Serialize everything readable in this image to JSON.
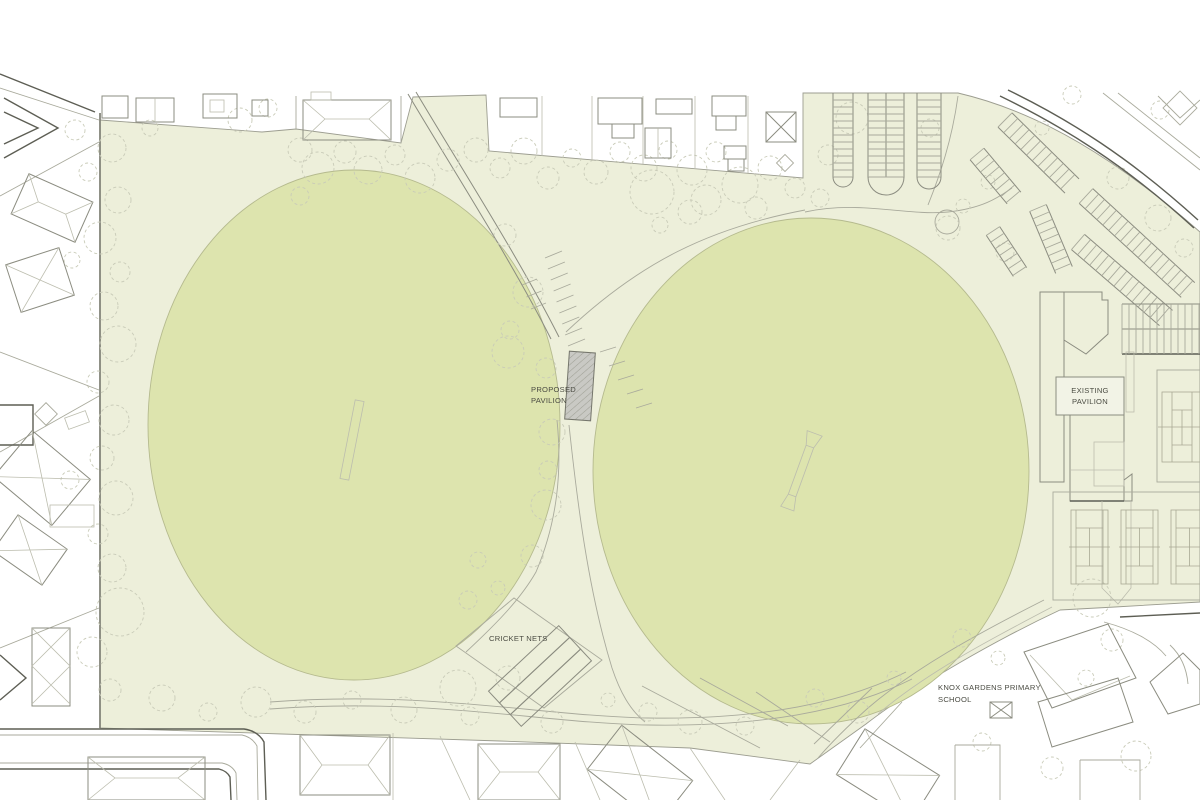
{
  "labels": {
    "proposed_pavilion_line1": "PROPOSED",
    "proposed_pavilion_line2": "PAVILION",
    "existing_pavilion_line1": "EXISTING",
    "existing_pavilion_line2": "PAVILION",
    "cricket_nets": "CRICKET NETS",
    "school_line1": "KNOX GARDENS PRIMARY",
    "school_line2": "SCHOOL"
  },
  "colors": {
    "background": "#ffffff",
    "park_fill": "#edefda",
    "oval_fill": "#dde4ae",
    "pavilion_fill": "#c9c9c4",
    "pavilion_hatch": "#9fa096",
    "label_box_fill": "#f2f3e6",
    "text": "#4b4c43"
  },
  "map": {
    "ovals": [
      {
        "name": "west-oval",
        "cx": 354,
        "cy": 425,
        "rx": 206,
        "ry": 255
      },
      {
        "name": "east-oval",
        "cx": 811,
        "cy": 471,
        "rx": 218,
        "ry": 253
      }
    ],
    "trees": [
      [
        300,
        150,
        12
      ],
      [
        318,
        168,
        16
      ],
      [
        345,
        152,
        11
      ],
      [
        368,
        170,
        14
      ],
      [
        395,
        155,
        10
      ],
      [
        420,
        178,
        15
      ],
      [
        448,
        160,
        11
      ],
      [
        300,
        196,
        9
      ],
      [
        476,
        150,
        12
      ],
      [
        500,
        168,
        10
      ],
      [
        524,
        151,
        13
      ],
      [
        548,
        178,
        11
      ],
      [
        572,
        158,
        9
      ],
      [
        596,
        172,
        12
      ],
      [
        620,
        152,
        10
      ],
      [
        644,
        168,
        13
      ],
      [
        668,
        150,
        9
      ],
      [
        692,
        170,
        15
      ],
      [
        716,
        152,
        10
      ],
      [
        740,
        185,
        18
      ],
      [
        770,
        168,
        12
      ],
      [
        795,
        188,
        10
      ],
      [
        652,
        192,
        22
      ],
      [
        706,
        200,
        15
      ],
      [
        756,
        208,
        11
      ],
      [
        820,
        198,
        9
      ],
      [
        240,
        120,
        12
      ],
      [
        268,
        108,
        9
      ],
      [
        150,
        128,
        8
      ],
      [
        112,
        148,
        14
      ],
      [
        88,
        172,
        9
      ],
      [
        118,
        200,
        13
      ],
      [
        100,
        238,
        16
      ],
      [
        120,
        272,
        10
      ],
      [
        104,
        306,
        14
      ],
      [
        118,
        344,
        18
      ],
      [
        98,
        382,
        11
      ],
      [
        114,
        420,
        15
      ],
      [
        102,
        458,
        12
      ],
      [
        116,
        498,
        17
      ],
      [
        98,
        534,
        10
      ],
      [
        112,
        568,
        14
      ],
      [
        120,
        612,
        24
      ],
      [
        92,
        652,
        15
      ],
      [
        110,
        690,
        11
      ],
      [
        75,
        130,
        10
      ],
      [
        70,
        480,
        9
      ],
      [
        72,
        260,
        8
      ],
      [
        505,
        235,
        11
      ],
      [
        528,
        292,
        15
      ],
      [
        510,
        330,
        9
      ],
      [
        546,
        368,
        10
      ],
      [
        508,
        352,
        16
      ],
      [
        552,
        432,
        13
      ],
      [
        548,
        470,
        9
      ],
      [
        546,
        505,
        15
      ],
      [
        532,
        556,
        11
      ],
      [
        478,
        560,
        8
      ],
      [
        468,
        600,
        9
      ],
      [
        498,
        588,
        7
      ],
      [
        690,
        212,
        12
      ],
      [
        660,
        225,
        8
      ],
      [
        162,
        698,
        13
      ],
      [
        208,
        712,
        9
      ],
      [
        256,
        702,
        15
      ],
      [
        305,
        712,
        11
      ],
      [
        352,
        700,
        9
      ],
      [
        404,
        710,
        13
      ],
      [
        458,
        688,
        18
      ],
      [
        508,
        678,
        12
      ],
      [
        470,
        716,
        9
      ],
      [
        552,
        722,
        11
      ],
      [
        608,
        700,
        7
      ],
      [
        648,
        712,
        9
      ],
      [
        690,
        722,
        12
      ],
      [
        745,
        726,
        9
      ],
      [
        815,
        698,
        9
      ],
      [
        858,
        712,
        11
      ],
      [
        852,
        118,
        16
      ],
      [
        828,
        155,
        10
      ],
      [
        948,
        228,
        12
      ],
      [
        988,
        182,
        7
      ],
      [
        930,
        128,
        9
      ],
      [
        1042,
        128,
        7
      ],
      [
        1005,
        252,
        9
      ],
      [
        963,
        206,
        7
      ],
      [
        1158,
        218,
        13
      ],
      [
        1184,
        248,
        9
      ],
      [
        1118,
        178,
        11
      ],
      [
        1072,
        95,
        9
      ],
      [
        1092,
        598,
        19
      ],
      [
        1112,
        640,
        11
      ],
      [
        962,
        638,
        9
      ],
      [
        998,
        658,
        7
      ],
      [
        1052,
        768,
        11
      ],
      [
        1136,
        756,
        15
      ],
      [
        982,
        742,
        9
      ],
      [
        894,
        678,
        7
      ],
      [
        1086,
        678,
        8
      ],
      [
        1160,
        110,
        9
      ]
    ],
    "parking": [
      {
        "type": "strip",
        "x": 843,
        "y": 93,
        "len": 84,
        "w": 20,
        "step": 7,
        "round": true
      },
      {
        "type": "strip",
        "x": 886,
        "y": 93,
        "len": 84,
        "w": 36,
        "step": 7,
        "round": true,
        "center": true
      },
      {
        "type": "strip",
        "x": 929,
        "y": 93,
        "len": 84,
        "w": 24,
        "step": 7,
        "round": true
      },
      {
        "type": "diag",
        "x1": 1005,
        "y1": 120,
        "x2": 1072,
        "y2": 186,
        "w": 20,
        "step": 8
      },
      {
        "type": "diag",
        "x1": 977,
        "y1": 154,
        "x2": 1014,
        "y2": 198,
        "w": 18,
        "step": 8
      },
      {
        "type": "diag",
        "x1": 1086,
        "y1": 196,
        "x2": 1188,
        "y2": 290,
        "w": 20,
        "step": 8
      },
      {
        "type": "diag",
        "x1": 1078,
        "y1": 242,
        "x2": 1166,
        "y2": 318,
        "w": 20,
        "step": 8
      },
      {
        "type": "diag",
        "x1": 1038,
        "y1": 208,
        "x2": 1064,
        "y2": 270,
        "w": 18,
        "step": 8
      },
      {
        "type": "diag",
        "x1": 993,
        "y1": 231,
        "x2": 1020,
        "y2": 272,
        "w": 16,
        "step": 8
      },
      {
        "type": "hstrip",
        "x": 1122,
        "y": 304,
        "len": 78,
        "w": 50,
        "step": 7,
        "center": true,
        "dark": true
      }
    ],
    "tick_rows": [
      {
        "x1": 545,
        "y1": 258,
        "x2": 568,
        "y2": 346,
        "n": 9,
        "dx": 17,
        "dy": -7
      },
      {
        "x1": 537,
        "y1": 279,
        "x2": 546,
        "y2": 303,
        "n": 3,
        "dx": -15,
        "dy": 6
      },
      {
        "x1": 600,
        "y1": 352,
        "x2": 636,
        "y2": 408,
        "n": 5,
        "dx": 16,
        "dy": -5
      }
    ],
    "tennis_courts": {
      "xs": [
        1071,
        1121,
        1171
      ],
      "y": 510,
      "w": 37,
      "h": 74
    }
  }
}
